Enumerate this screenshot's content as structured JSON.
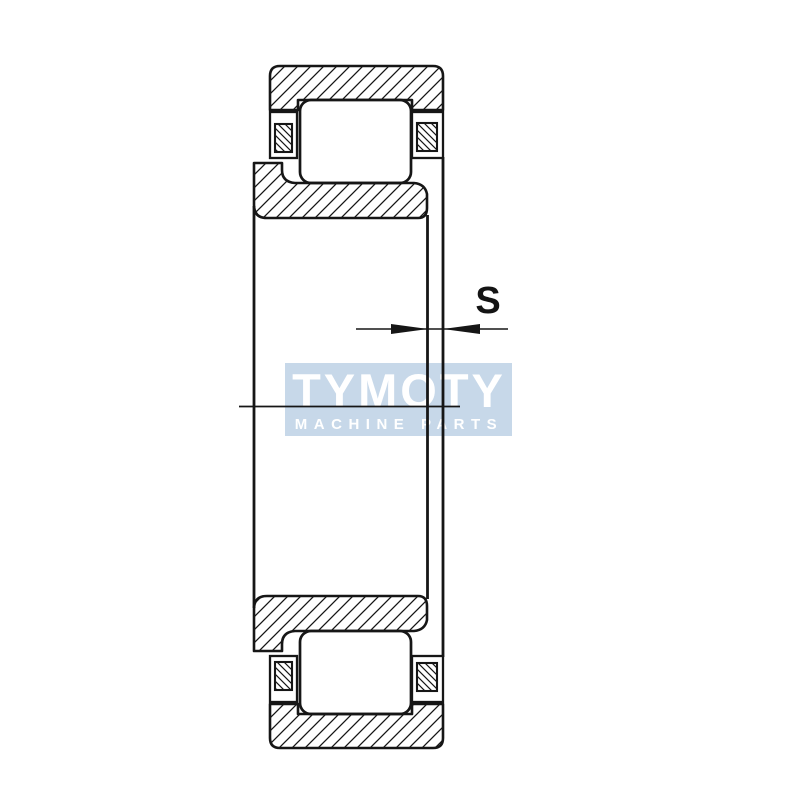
{
  "canvas": {
    "background": "#ffffff",
    "line_color": "#161616"
  },
  "watermark": {
    "line1": "TYMOTY",
    "line2": "MACHINE PARTS",
    "bg_color": "#c7d8e9",
    "text_color": "#ffffff"
  },
  "dimension": {
    "label": "S"
  }
}
